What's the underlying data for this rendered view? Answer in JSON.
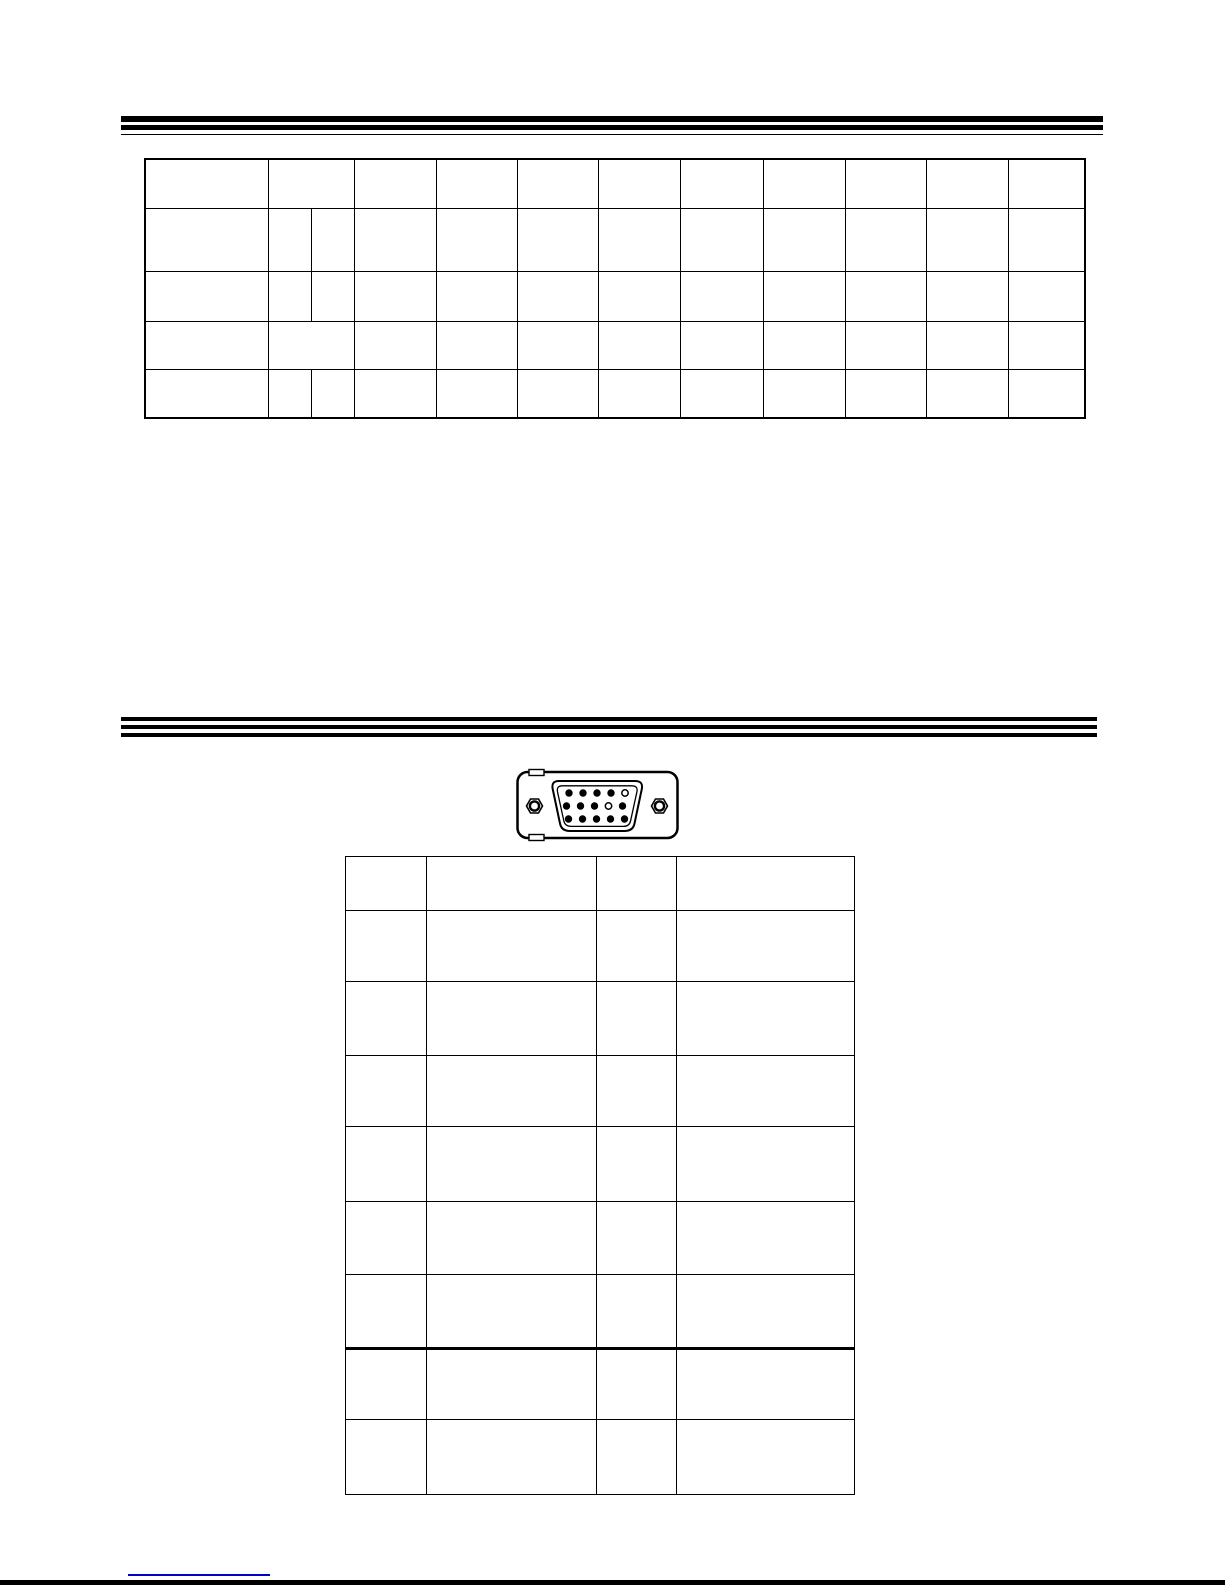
{
  "page": {
    "background_color": "#ffffff",
    "ink_color": "#000000"
  },
  "top_section": {
    "table": {
      "row_count": 5,
      "column_count": 11,
      "cell_text": ""
    }
  },
  "bottom_section": {
    "connector": {
      "kind": "15-pin-d-sub",
      "pin_rows": [
        [
          1,
          1,
          1,
          1,
          0
        ],
        [
          1,
          1,
          1,
          0,
          1
        ],
        [
          1,
          1,
          1,
          1,
          1
        ]
      ]
    },
    "table": {
      "row_count": 9,
      "column_count": 4,
      "cell_text": ""
    }
  },
  "footer": {
    "link": {
      "text": "",
      "underline_color": "#0000cc"
    },
    "bottom_bar_color": "#000000"
  }
}
